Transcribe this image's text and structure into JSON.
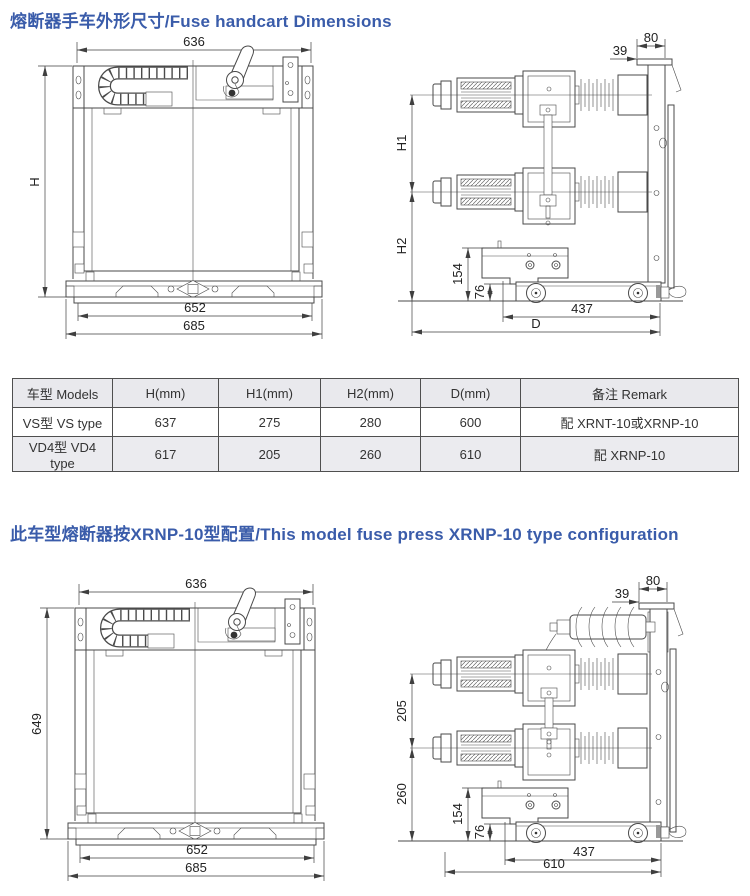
{
  "titles": {
    "section1": "熔断器手车外形尺寸/Fuse handcart Dimensions",
    "section2": "此车型熔断器按XRNP-10型配置/This model fuse press XRNP-10 type configuration"
  },
  "drawings": {
    "front1": {
      "top": "636",
      "left": "H",
      "bottom_inner": "652",
      "bottom_outer": "685"
    },
    "side1": {
      "top_outer": "80",
      "top_inner": "39",
      "left_upper": "H1",
      "left_lower": "H2",
      "mid_upper": "154",
      "mid_lower": "76",
      "bottom_inner": "437",
      "bottom_outer": "D"
    },
    "front2": {
      "top": "636",
      "left": "649",
      "bottom_inner": "652",
      "bottom_outer": "685"
    },
    "side2": {
      "top_outer": "80",
      "top_inner": "39",
      "left_upper": "205",
      "left_lower": "260",
      "mid_upper": "154",
      "mid_lower": "76",
      "bottom_inner": "437",
      "bottom_outer": "610"
    }
  },
  "table": {
    "headers": [
      "车型 Models",
      "H(mm)",
      "H1(mm)",
      "H2(mm)",
      "D(mm)",
      "备注 Remark"
    ],
    "rows": [
      [
        "VS型 VS type",
        "637",
        "275",
        "280",
        "600",
        "配 XRNT-10或XRNP-10"
      ],
      [
        "VD4型 VD4 type",
        "617",
        "205",
        "260",
        "610",
        "配 XRNP-10"
      ]
    ]
  },
  "colors": {
    "title_blue": "#3a5caa",
    "line": "#4a4a4a",
    "header_bg": "#e9e9ed"
  }
}
